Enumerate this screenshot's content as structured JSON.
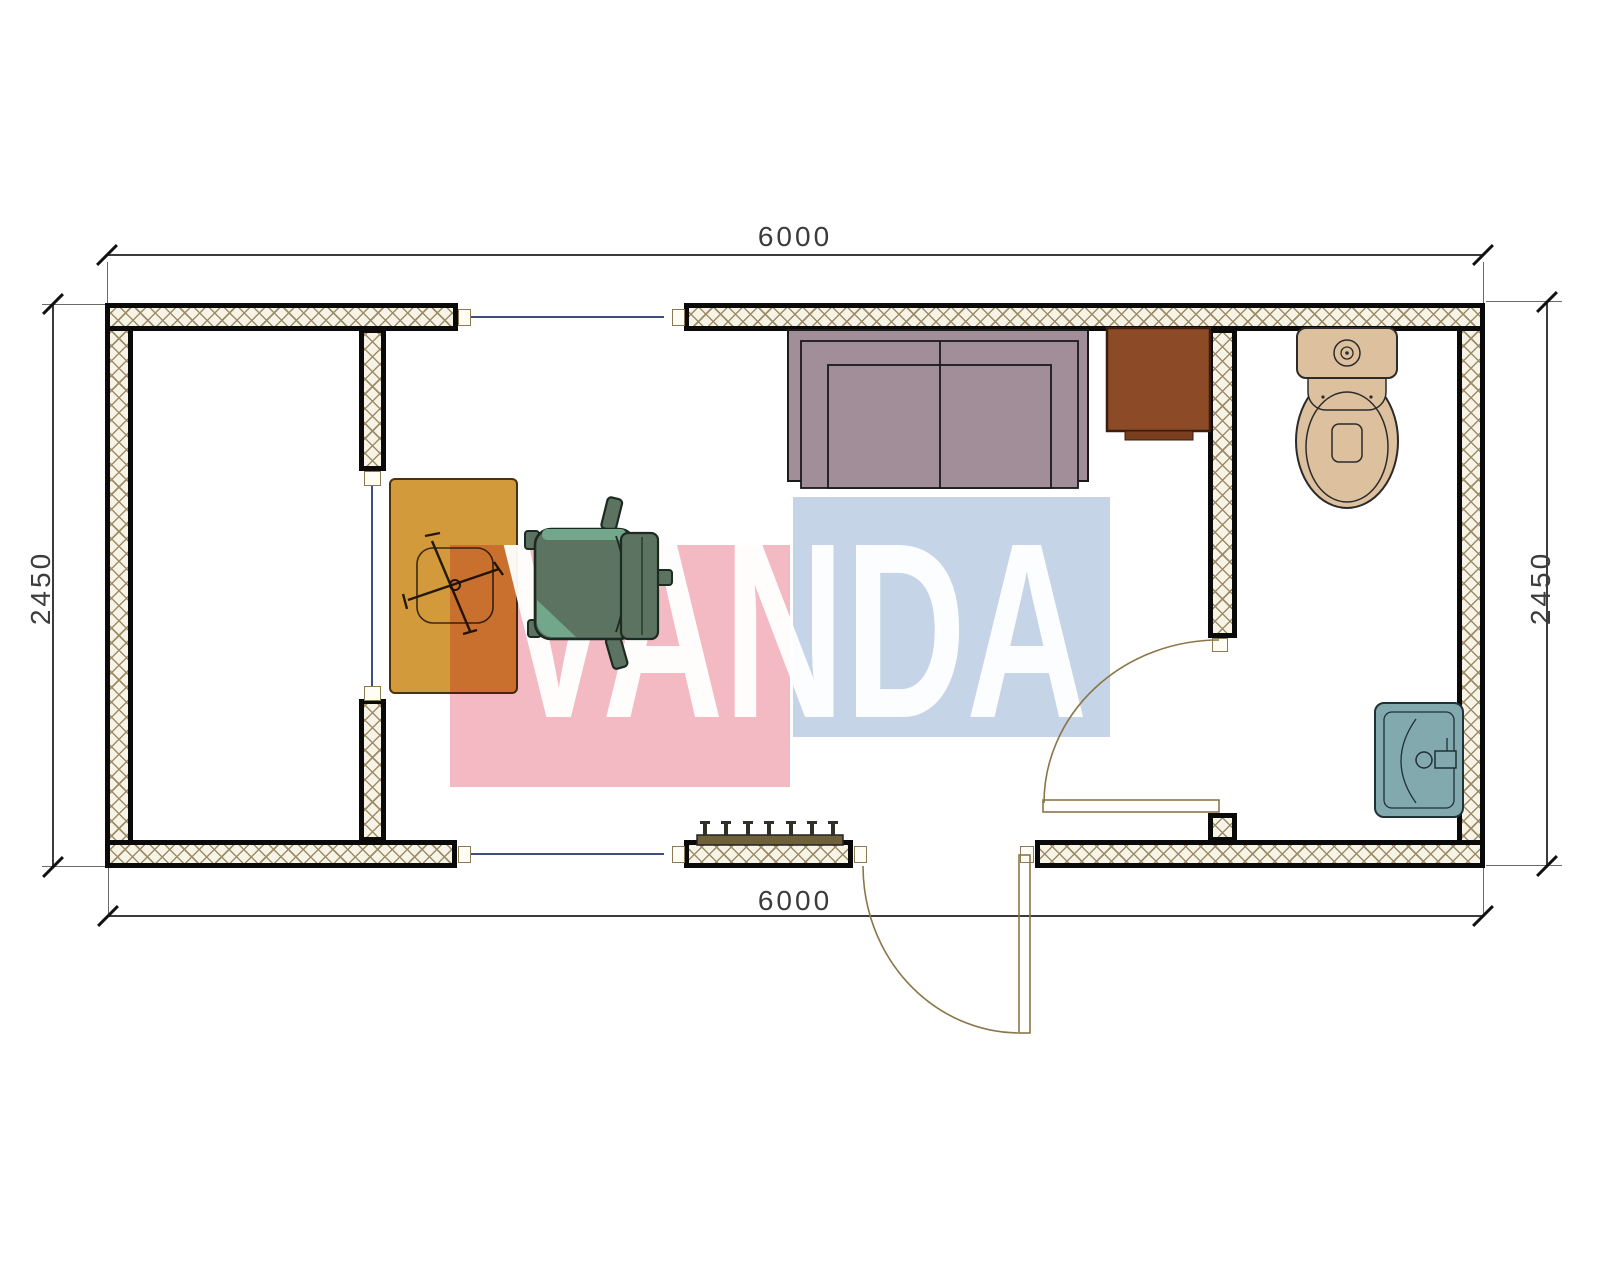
{
  "page": {
    "type": "architectural floor plan, top view, 6000 x 2450 container cabin"
  },
  "dimensions": {
    "top": {
      "label": "6000"
    },
    "bottom": {
      "label": "6000"
    },
    "left": {
      "label": "2450"
    },
    "right": {
      "label": "2450"
    }
  },
  "watermark": {
    "text": "VANDA",
    "text_color": "#FFFFFF",
    "pink_block": "#F4BAC4",
    "blue_block": "#C6D4E7"
  },
  "palette": {
    "wall-fill": "#F7F3E6",
    "wall-hatch": "#9C8D68",
    "wall-border": "#0A0A0A",
    "dim-line": "#3C3C3C",
    "ext-line": "#6A6A6A",
    "centerline": "#3F4E82",
    "door-line": "#8A7648",
    "sofa": "#A28E99",
    "desk": "#D29A3B",
    "cabinet": "#8C4A26",
    "cabinet-strip": "#7A3E1E",
    "chair": "#5C7362",
    "chair-accent": "#73A78C",
    "toilet": "#DDC19E",
    "sink": "#81A9AE",
    "radiator": "#6F6039",
    "wm-pink": "#F4BAC4",
    "wm-blue": "#C6D4E7"
  },
  "icons": [
    "sofa",
    "desk",
    "office-chair",
    "chair-star-base",
    "cabinet",
    "toilet",
    "sink",
    "radiator",
    "entrance-door",
    "bathroom-door",
    "wall-opening-jamb",
    "dimension-tick"
  ]
}
